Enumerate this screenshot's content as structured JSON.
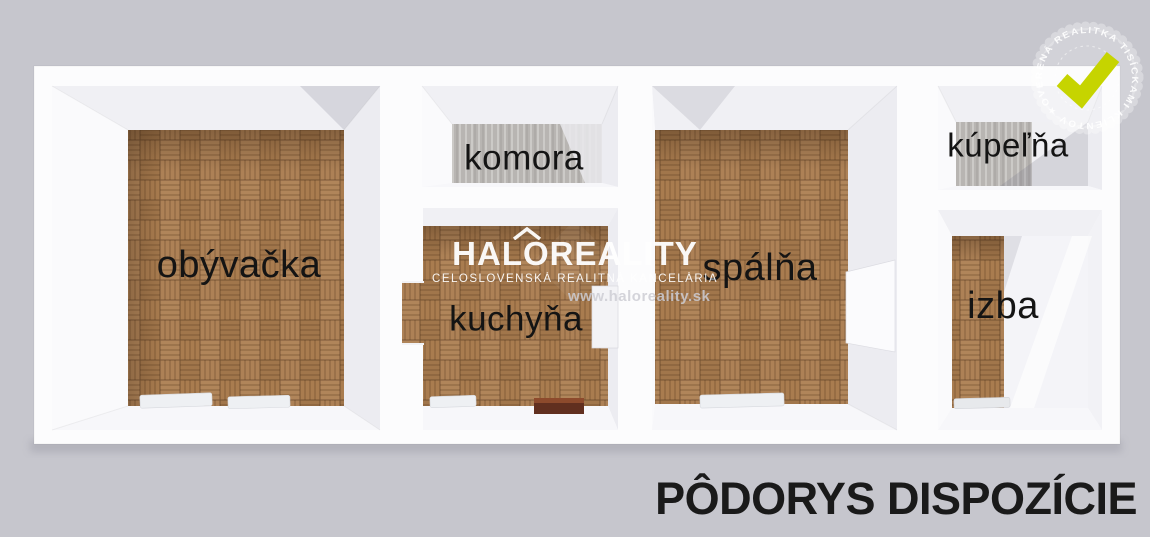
{
  "colors": {
    "background": "#c6c6cd",
    "wall_white": "#fcfcfd",
    "parquet_base": "#a87e53",
    "concrete_gray": "#b8b5b2",
    "check_green": "#c6d400",
    "label_text": "#141414"
  },
  "rooms": [
    {
      "id": "obyvacka",
      "label": "obývačka",
      "floor": "parquet"
    },
    {
      "id": "komora",
      "label": "komora",
      "floor": "concrete"
    },
    {
      "id": "kuchyna",
      "label": "kuchyňa",
      "floor": "parquet"
    },
    {
      "id": "spalna",
      "label": "spálňa",
      "floor": "parquet"
    },
    {
      "id": "kupelna",
      "label": "kúpeľňa",
      "floor": "white-tile"
    },
    {
      "id": "izba",
      "label": "izba",
      "floor": "parquet"
    }
  ],
  "watermark": {
    "brand": "HALOREALITY",
    "subtitle": "CELOSLOVENSKÁ REALITNÁ KANCELÁRIA",
    "url": "www.haloreality.sk"
  },
  "badge": {
    "ring_text": "OVERENÁ REALITKA TISÍCKAMI KLIENTOV ★"
  },
  "caption": "PÔDORYS DISPOZÍCIE"
}
